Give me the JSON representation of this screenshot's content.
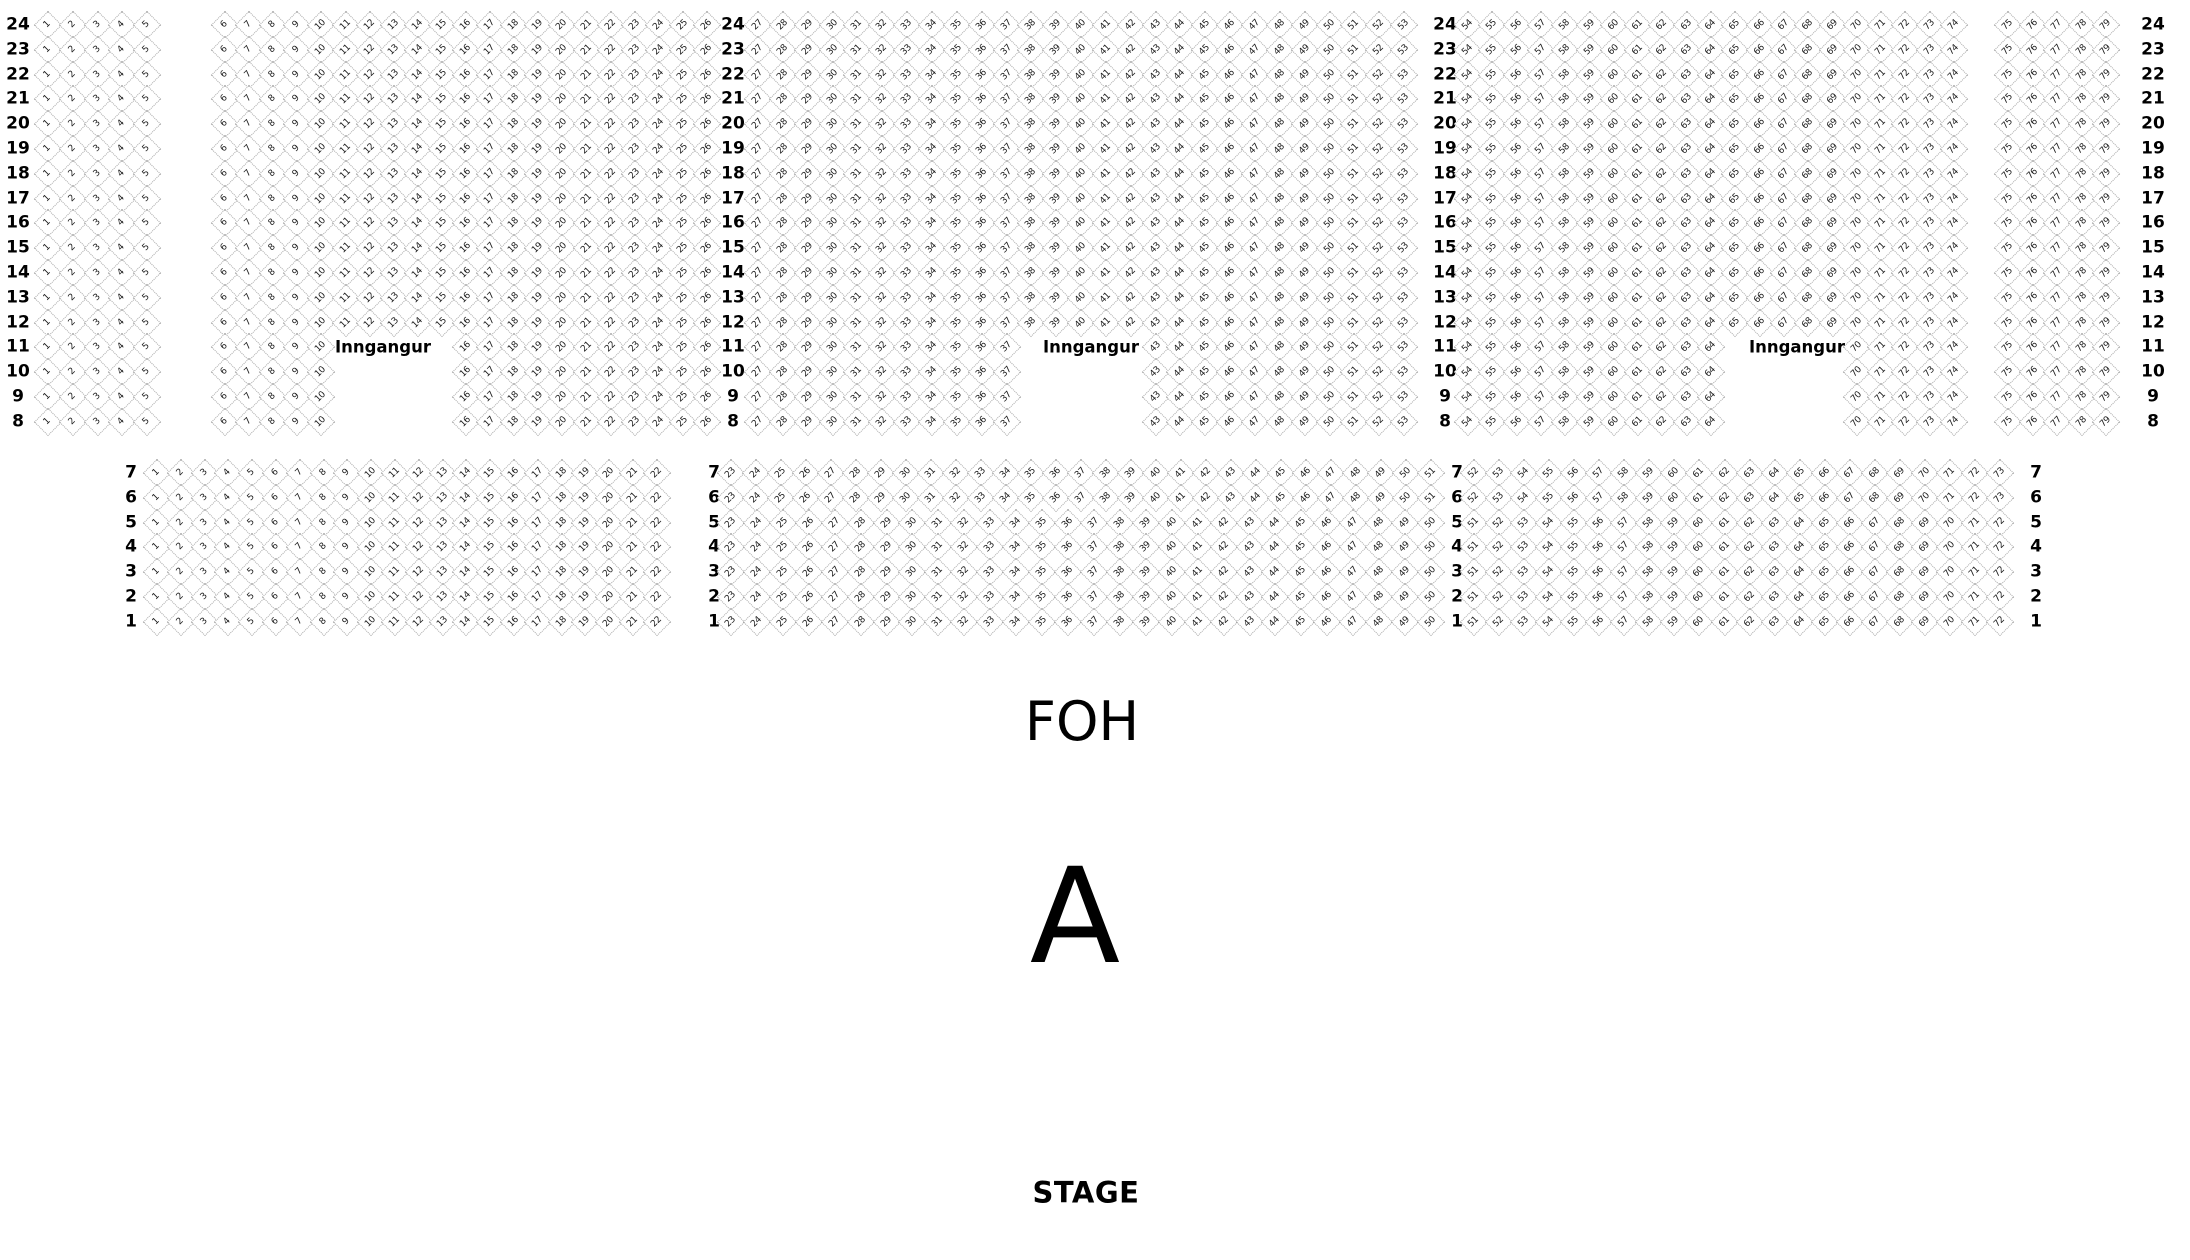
{
  "labels": {
    "foh": "FOH",
    "section": "A",
    "stage": "STAGE",
    "entrance": "Inngangur"
  },
  "seatmap": {
    "top": {
      "row_numbers": [
        24,
        23,
        22,
        21,
        20,
        19,
        18,
        17,
        16,
        15,
        14,
        13,
        12,
        11,
        10,
        9,
        8
      ],
      "blocks": [
        {
          "from": 1,
          "to": 5
        },
        {
          "from": 6,
          "to": 26
        },
        {
          "from": 27,
          "to": 53
        },
        {
          "from": 54,
          "to": 74
        },
        {
          "from": 75,
          "to": 79
        }
      ],
      "entrance_gap_rows": [
        11,
        10,
        9,
        8
      ],
      "entrance_gap_seats": [
        {
          "from": 11,
          "to": 15
        },
        {
          "from": 38,
          "to": 42
        },
        {
          "from": 65,
          "to": 69
        }
      ]
    },
    "bottom": {
      "row_numbers": [
        7,
        6,
        5,
        4,
        3,
        2,
        1
      ],
      "long_rows": [
        7,
        6
      ],
      "blocks_long": [
        {
          "from": 1,
          "to": 22
        },
        {
          "from": 23,
          "to": 51
        },
        {
          "from": 52,
          "to": 73
        }
      ],
      "blocks_short": [
        {
          "from": 1,
          "to": 22
        },
        {
          "from": 23,
          "to": 50
        },
        {
          "from": 51,
          "to": 72
        }
      ]
    }
  }
}
